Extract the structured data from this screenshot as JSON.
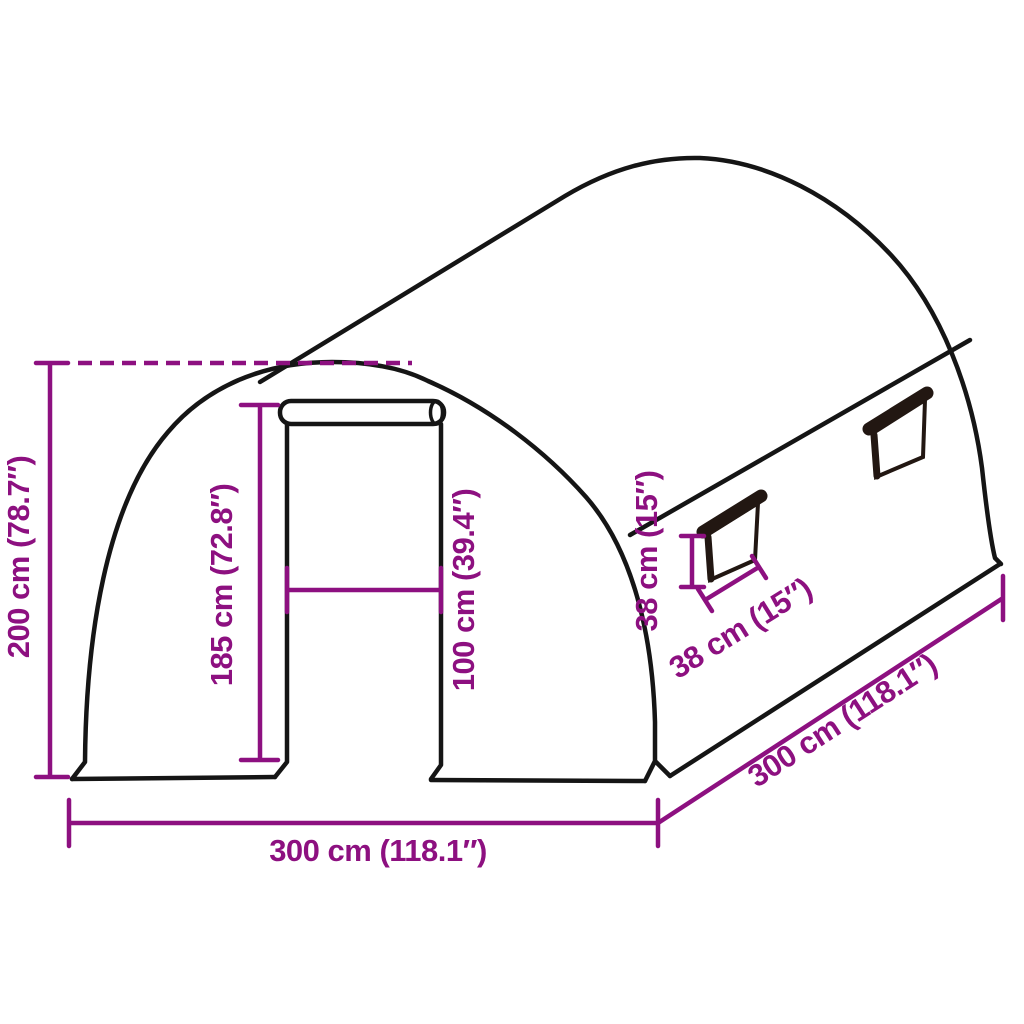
{
  "diagram": {
    "title": "Polytunnel greenhouse dimension diagram",
    "colors": {
      "background": "#ffffff",
      "outline": "#151515",
      "dimension": "#8d1080",
      "window_frame": "#221712"
    },
    "labels": {
      "total_height": "200 cm (78.7″)",
      "door_height": "185 cm (72.8″)",
      "door_width": "100 cm (39.4″)",
      "window_height": "38 cm (15″)",
      "window_width": "38 cm (15″)",
      "front_width": "300 cm (118.1″)",
      "side_length": "300 cm (118.1″)"
    }
  }
}
